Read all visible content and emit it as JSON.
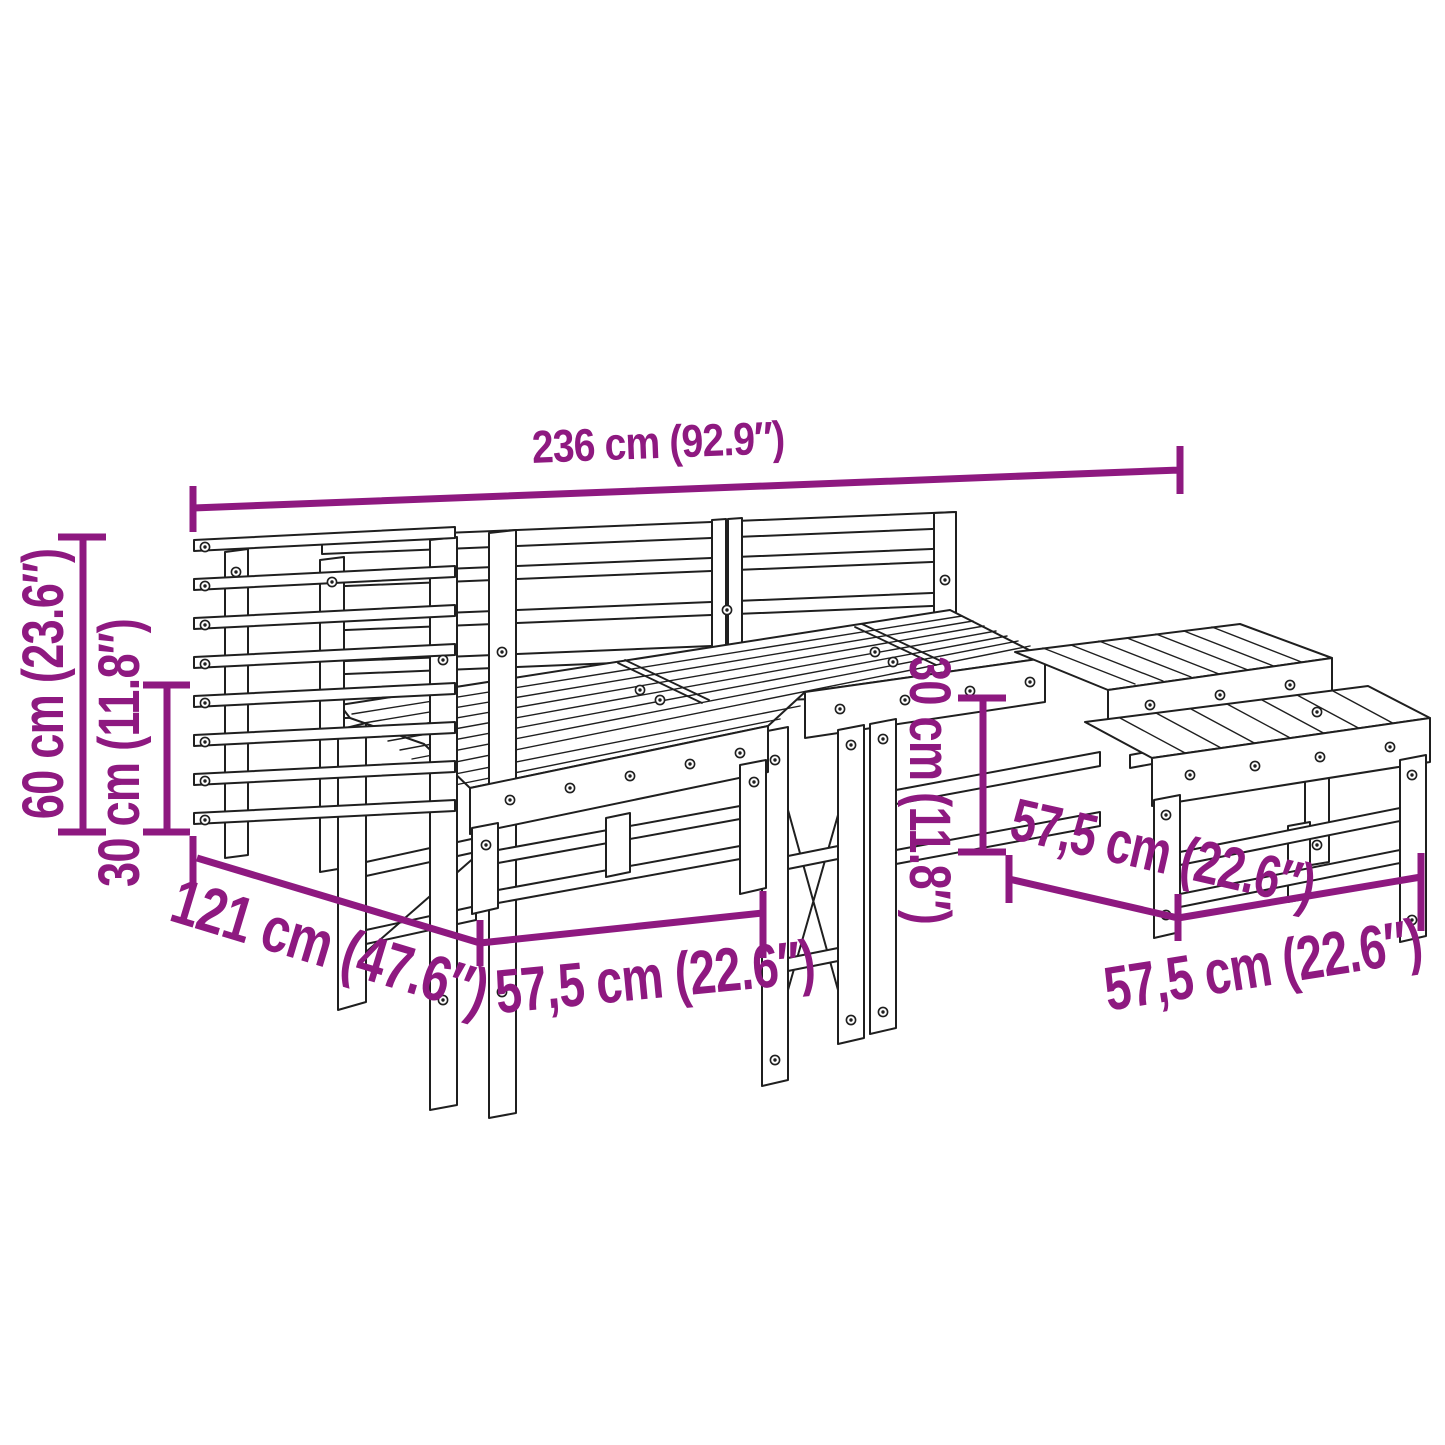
{
  "page": {
    "background": "#ffffff",
    "type": "product-dimension-diagram"
  },
  "colors": {
    "dimension_annotation": "#8E1980",
    "line_art": "#1f1f1f"
  },
  "dimensions": {
    "overall_width": {
      "label": "236 cm (92.9″)"
    },
    "overall_height": {
      "label": "60 cm (23.6″)"
    },
    "seat_height": {
      "label": "30 cm (11.8″)"
    },
    "overall_depth": {
      "label": "121 cm (47.6″)"
    },
    "module_width": {
      "label": "57,5 cm (22.6″)"
    },
    "footstool_height": {
      "label": "30 cm (11.8″)"
    },
    "footstool_depth": {
      "label": "57,5 cm (22.6″)"
    },
    "footstool_width": {
      "label": "57,5 cm (22.6″)"
    }
  }
}
